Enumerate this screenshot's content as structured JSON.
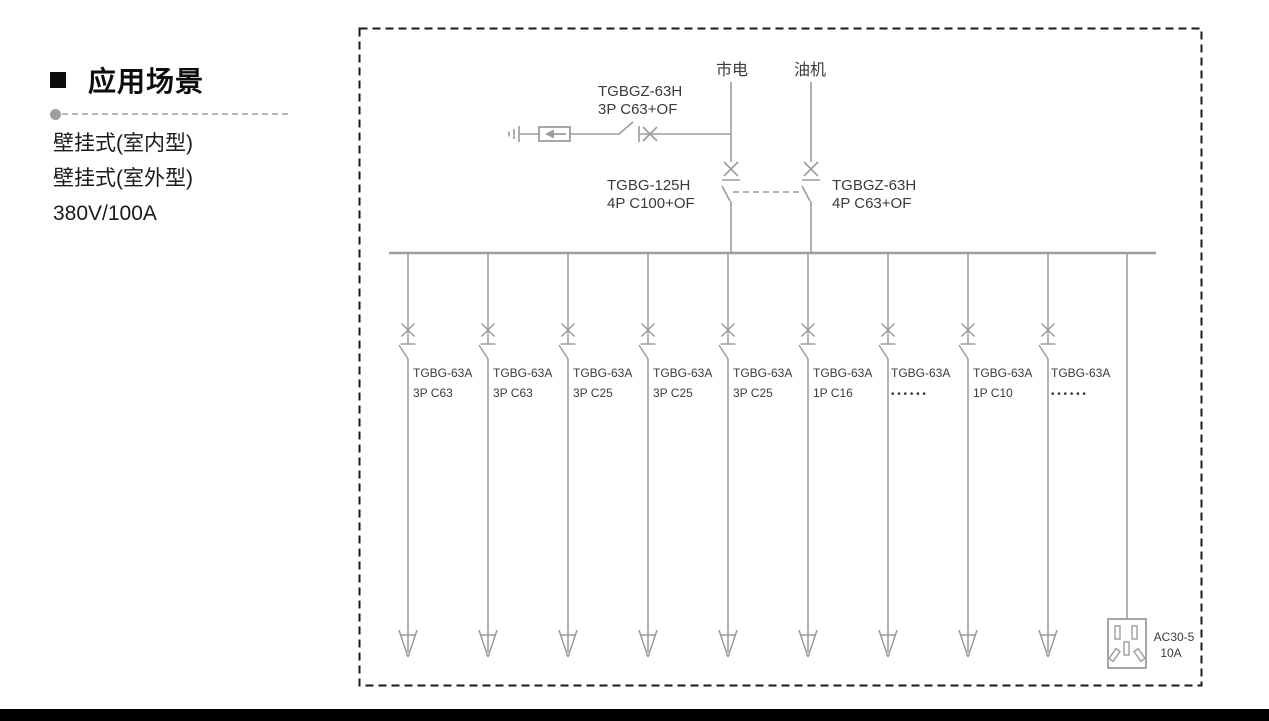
{
  "sidebar": {
    "heading": "应用场景",
    "items": [
      "壁挂式(室内型)",
      "壁挂式(室外型)",
      "380V/100A"
    ]
  },
  "diagram": {
    "sources": [
      {
        "label": "市电"
      },
      {
        "label": "油机"
      }
    ],
    "spd_branch": {
      "model": "TGBGZ-63H",
      "spec": "3P C63+OF"
    },
    "main_breakers": [
      {
        "model": "TGBG-125H",
        "spec": "4P C100+OF"
      },
      {
        "model": "TGBGZ-63H",
        "spec": "4P C63+OF"
      }
    ],
    "branches": [
      {
        "model": "TGBG-63A",
        "spec": "3P C63"
      },
      {
        "model": "TGBG-63A",
        "spec": "3P C63"
      },
      {
        "model": "TGBG-63A",
        "spec": "3P C25"
      },
      {
        "model": "TGBG-63A",
        "spec": "3P C25"
      },
      {
        "model": "TGBG-63A",
        "spec": "3P C25"
      },
      {
        "model": "TGBG-63A",
        "spec": "1P C16"
      },
      {
        "model": "TGBG-63A",
        "spec": "• • • • • •"
      },
      {
        "model": "TGBG-63A",
        "spec": "1P C10"
      },
      {
        "model": "TGBG-63A",
        "spec": "• • • • • •"
      }
    ],
    "outlet": {
      "model": "AC30-5",
      "rating": "10A"
    },
    "colors": {
      "line": "#9c9c9c",
      "label": "#3b3b3b",
      "border": "#1a1a1a",
      "footer_bar": "#000000"
    }
  }
}
